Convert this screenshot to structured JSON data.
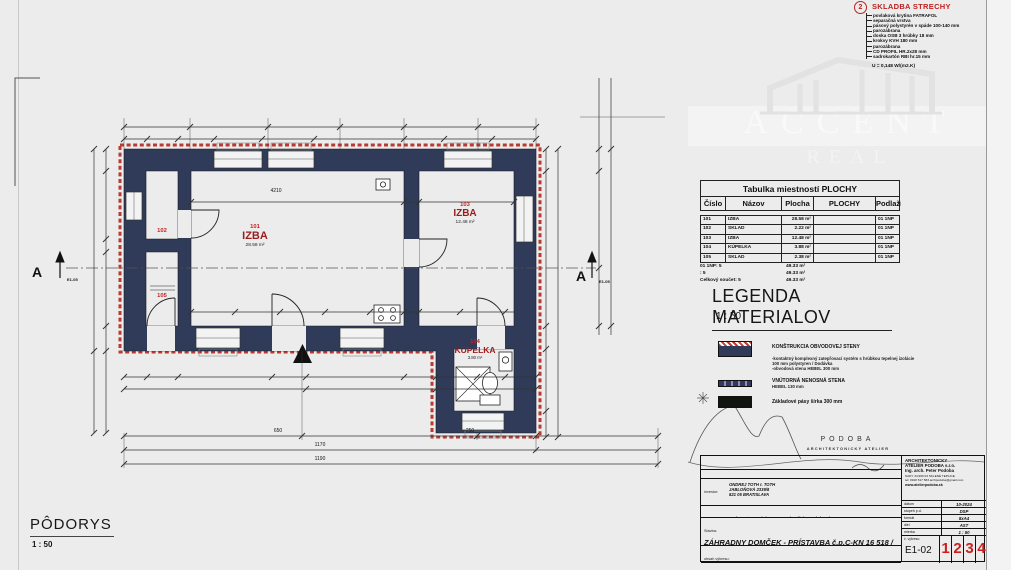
{
  "page": {
    "watermark_line1": "ACCENT",
    "watermark_line2": "REAL"
  },
  "plan": {
    "title": "PÔDORYS",
    "scale": "1 : 50",
    "section_label": "A",
    "section_ref": "E1-05",
    "rooms": [
      {
        "number": "101",
        "name": "IZBA",
        "area": "28.58 m²"
      },
      {
        "number": "102",
        "name": "SKLAD"
      },
      {
        "number": "103",
        "name": "IZBA",
        "area": "12.48 m²"
      },
      {
        "number": "104",
        "name": "KÚPELKA",
        "area": "3.80 m²"
      },
      {
        "number": "105",
        "name": "SKLAD"
      }
    ],
    "dim_labels": [
      {
        "t": "4210",
        "x": 276,
        "y": 188
      },
      {
        "t": "650",
        "x": 278,
        "y": 428
      },
      {
        "t": "250",
        "x": 470,
        "y": 428
      },
      {
        "t": "1170",
        "x": 320,
        "y": 442
      },
      {
        "t": "1190",
        "x": 320,
        "y": 456
      }
    ]
  },
  "roof_legend": {
    "index": "2",
    "title": "SKLADBA STRECHY",
    "items": [
      "povlaková krytina FATRAFOL",
      "separačná vrstva",
      "pásový polystyrén v spáde 100-140 mm",
      "parozábrana",
      "doska OSB 3 hrúbky 18 mm",
      "krokvy KVH 180 mm",
      "parozábrana",
      "CD PROFIL HR.2x28 mm",
      "sadrokartón RBI hr.15 mm"
    ],
    "u_value": "U = 0,148 W/(m2.K)"
  },
  "room_table": {
    "title": "Tabulka miestností  PLOCHY",
    "headers": [
      "Číslo",
      "Názov",
      "Plocha",
      "PLOCHY",
      "Podlaží"
    ],
    "rows": [
      [
        "101",
        "IZBA",
        "28.58 m²",
        "",
        "01 1NP"
      ],
      [
        "102",
        "SKLAD",
        "2.22 m²",
        "",
        "01 1NP"
      ],
      [
        "103",
        "IZBA",
        "12.48 m²",
        "",
        "01 1NP"
      ],
      [
        "104",
        "KÚPELKA",
        "3.88 m²",
        "",
        "01 1NP"
      ],
      [
        "105",
        "SKLAD",
        "2.38 m²",
        "",
        "01 1NP"
      ]
    ],
    "summary": [
      [
        "01 1NP: 5",
        "49.33 m²"
      ],
      [
        ": 5",
        "49.33 m²"
      ],
      [
        "Celkový součet: 5",
        "49.33 m²"
      ]
    ]
  },
  "materials_legend": {
    "title": "LEGENDA MATERIALOV",
    "scale": "1 : 50",
    "items": [
      {
        "label": "KONŠTRUKCIA OBVODOVEJ STENY",
        "desc1": "-kontaktný komplexný zatepľovací systém s hrúbkou tepelnej izolácie",
        "desc2": "100 mm  polystyren / Dodávka",
        "desc3": "-obvodová stena HEBEL 300 mm"
      },
      {
        "label": "VNÚTORNÁ NENOSNÁ STENA",
        "desc1": "HEBEL  130 mm"
      },
      {
        "label": "Základové pásy šírka 300 mm"
      }
    ]
  },
  "logo": {
    "name": "PODOBA",
    "subtitle": "ARCHITEKTONICKÝ ATELIER"
  },
  "title_block": {
    "responsible_label": "zodpovedný  projektant:",
    "responsible": "Ing. arch. Peter Podoba",
    "investor_label": "investor:",
    "investor_lines": [
      "ONDREJ TOTH r. TOTH",
      "JABLOŇOVÁ 2339/8",
      "821 05 BRATISLAVA"
    ],
    "authors_label": "autori:",
    "authors": "Ing. arch. Peter Podoba, Ing. arch. Silvia Podobová",
    "project_label": "Stavba:",
    "project_line1": "ZÁHRADNY DOMČEK - PRÍSTAVBA   č.p.C-KN 16 518 /",
    "project_line2": "410,411 k.ú. TRNÁVKA  okr. BA II.",
    "content_label": "obsah výkresu:",
    "content": "PÔDORYS +0,000",
    "firm_lines": [
      "ARCHITEKTONICKY",
      "ATELIER PODOBA s.r.o.",
      "Ing. arch. Peter Podoba",
      "SADY 34,966 03 SKLENÉ TEPLICE",
      "tel: 0918 517 583  archpodoba@gmail.com",
      "www.atelierpodoba.sk"
    ],
    "fields": [
      [
        "dátum",
        "10-2024"
      ],
      [
        "stupeň p.d.",
        "DSP"
      ],
      [
        "formát",
        "8xA4"
      ],
      [
        "diel",
        "AST"
      ],
      [
        "mierka",
        "1 : 50"
      ]
    ],
    "drawing_no_label": "č. výkresu:",
    "drawing_no": "E1-02",
    "sheet_numbers": [
      "1",
      "2",
      "3",
      "4"
    ]
  },
  "colors": {
    "wall": "#2f3b58",
    "accent_red": "#c01f1f",
    "insulation": "#b83a32"
  }
}
